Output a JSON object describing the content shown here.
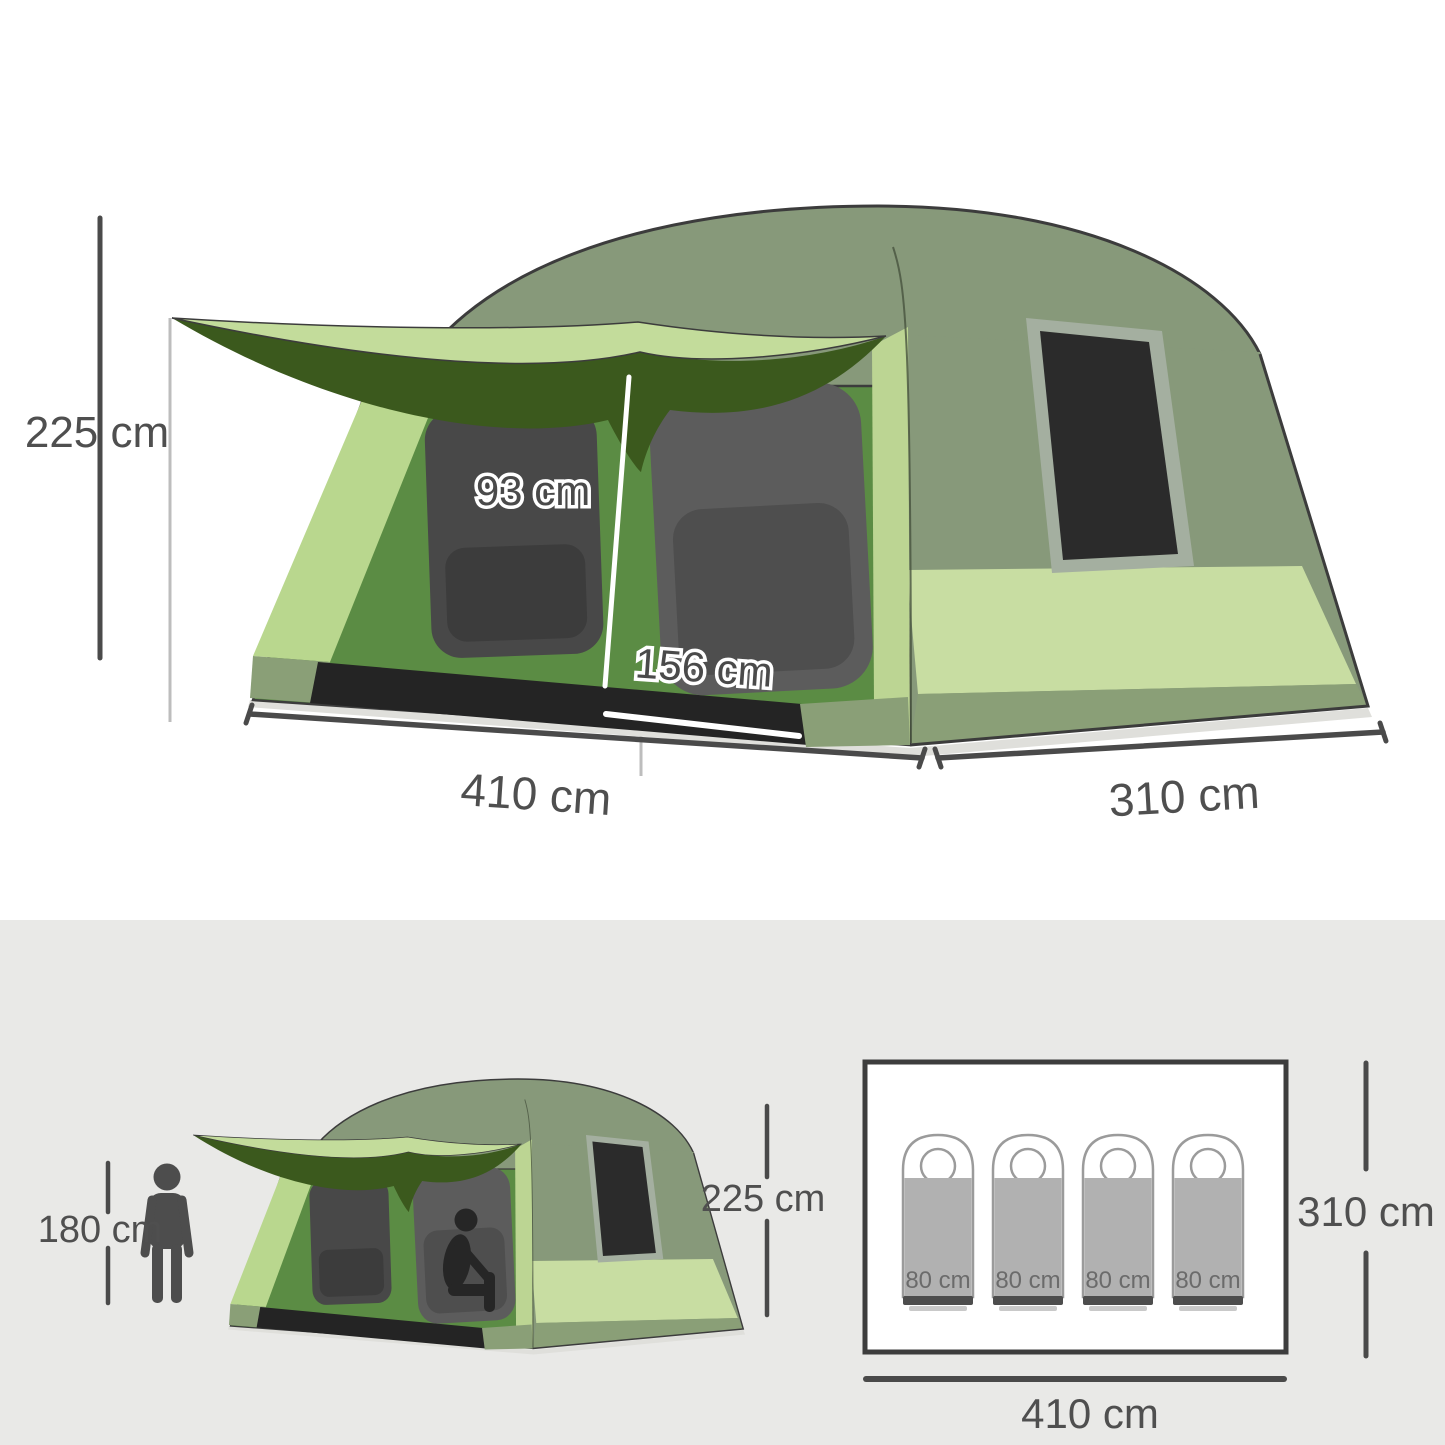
{
  "palette": {
    "roof_sage": "#87997A",
    "awning_top": "#C3DC9B",
    "awning_underside": "#3B591D",
    "front_green": "#5B8C44",
    "front_left_panel": "#B9D78E",
    "front_right_strip": "#BCD593",
    "side_band_light": "#C8DDA2",
    "band_olive": "#8A9F77",
    "mesh_window": "#484848",
    "mesh_door": "#5C5C5C",
    "side_window_black": "#2B2B2B",
    "side_window_frame": "#A4AFA0",
    "base_black": "#242424",
    "outline_dark": "#3C3C3C",
    "dimension_line": "#4A4A4A",
    "dimension_text": "#4F4F4F",
    "extension_line": "#BDBDBD",
    "person_silhouette": "#4D4D4D",
    "bottom_section_bg": "#E9E9E7",
    "floor_plan_border": "#3D3D3D",
    "sleeping_bag_gray": "#B1B1B1",
    "sleeping_bag_outline": "#9B9B9B",
    "sleeping_bag_bar": "#4D4D4D"
  },
  "top_diagram": {
    "height_label": "225 cm",
    "door_height_label": "93 cm",
    "door_width_label": "156 cm",
    "width_label": "410 cm",
    "depth_label": "310 cm"
  },
  "bottom_diagram": {
    "person_height_label": "180 cm",
    "tent_height_label": "225 cm"
  },
  "floor_plan": {
    "depth_label": "310 cm",
    "width_label": "410 cm",
    "bags": [
      {
        "label": "80 cm"
      },
      {
        "label": "80 cm"
      },
      {
        "label": "80 cm"
      },
      {
        "label": "80 cm"
      }
    ]
  }
}
